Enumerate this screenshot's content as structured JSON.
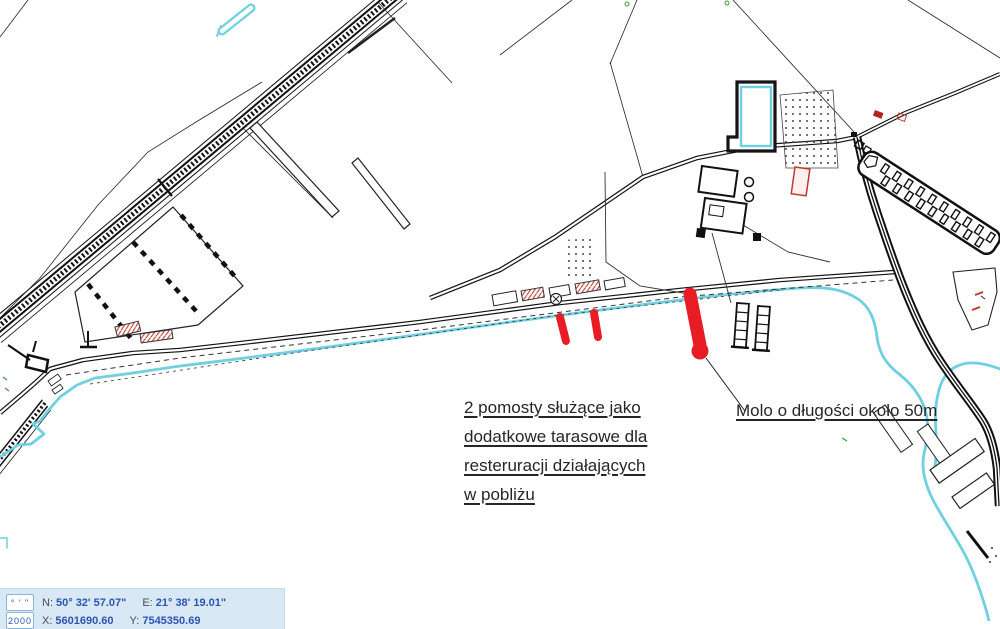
{
  "map": {
    "annotations": {
      "pomosty_lines": [
        "2 pomosty służące jako",
        "dodatkowe tarasowe dla",
        "resteruracji działających",
        "w pobliżu"
      ],
      "molo": "Molo o długości około 50m"
    },
    "colors": {
      "river": "#6fd0e2",
      "marker_red": "#e81c24",
      "line_black": "#111111",
      "hatch_red": "#c0392b"
    }
  },
  "statusbar": {
    "format_button": "° ' \"",
    "system_button": "2000",
    "n_label": "N:",
    "n_value": "50° 32' 57.07\"",
    "e_label": "E:",
    "e_value": "21° 38' 19.01\"",
    "x_label": "X:",
    "x_value": "5601690.60",
    "y_label": "Y:",
    "y_value": "7545350.69",
    "colors": {
      "panel_bg": "#d9e8f5",
      "value_text": "#2b55b0",
      "label_text": "#4a4a55",
      "box_border": "#8ab4d8"
    }
  }
}
